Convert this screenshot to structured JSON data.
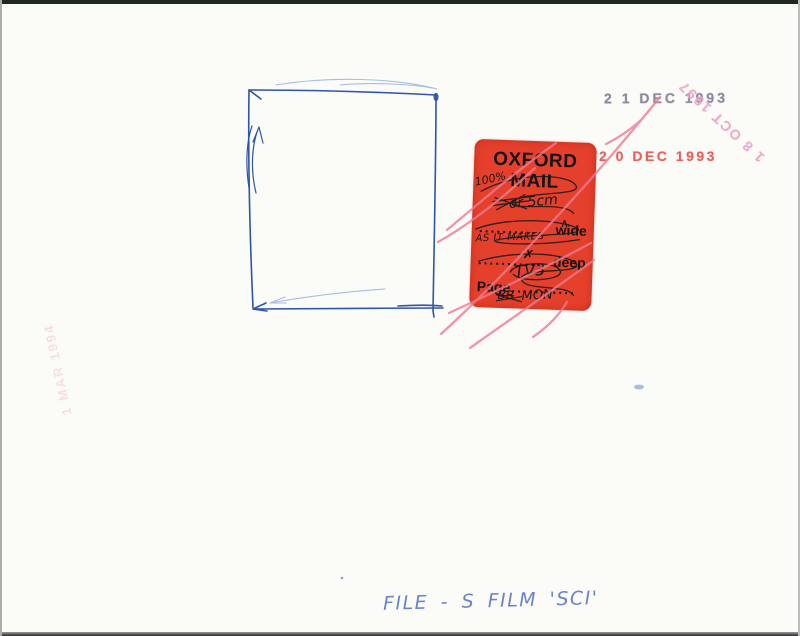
{
  "stamps": [
    {
      "name": "date-stamp-grey",
      "text": "2 1 DEC 1993",
      "color": "#8d8a9f"
    },
    {
      "name": "date-stamp-red",
      "text": "2 0 DEC 1993",
      "color": "#e25850"
    },
    {
      "name": "date-stamp-rotated",
      "text": "1 8 OCT 1997",
      "color": "#efa3c6"
    },
    {
      "name": "date-stamp-faint",
      "text": "1 MAR 1994",
      "color": "#ef97a6"
    }
  ],
  "sticker": {
    "title_line1": "OXFORD",
    "title_line2": "MAIL",
    "rows": {
      "wide_dots": "..........",
      "wide_label": "wide",
      "deep_dots": "...........",
      "deep_label": "deep",
      "page_label": "Page",
      "page_dots": "..........."
    },
    "handwriting": {
      "note_percent": "100%",
      "size_note": "or 5cm",
      "as_it_makes": "AS IT MAKES",
      "wide_mark": "∧",
      "deep_mark": "✗",
      "page_value": "TV3",
      "crossed_initials": "BB",
      "day_note": "MON"
    },
    "background_color": "#e5402c"
  },
  "caption": {
    "text": "FILE - S FILM 'SCI'"
  },
  "colors": {
    "pen_blue": "#2e55a8",
    "marker_pink": "#ee7b93",
    "caption_blue": "#6b84c6",
    "paper": "#fbfbf8"
  }
}
